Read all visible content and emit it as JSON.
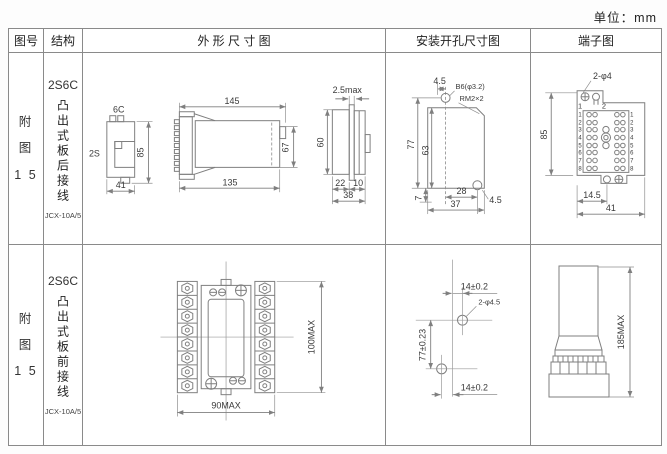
{
  "unit_label": "单位：mm",
  "headers": {
    "fig_no": "图号",
    "structure": "结构",
    "outline": "外 形 尺 寸 图",
    "mounting": "安装开孔尺寸图",
    "terminal": "端子图"
  },
  "rows": [
    {
      "fig_no": "附\n图\n1 5",
      "model": "2S6C",
      "structure_desc": "凸出式板后接线",
      "socket_note": "JCX-10A/5",
      "outline": {
        "view1": {
          "top": "6C",
          "left": "2S",
          "height": "85",
          "width": "41"
        },
        "view2": {
          "top": "145",
          "bottom": "135",
          "right": "67"
        },
        "view3": {
          "top": "2.5max",
          "left": "60",
          "b1": "22",
          "b2": "10",
          "b3": "38"
        }
      },
      "mounting": {
        "top_offset": "4.5",
        "hole_label": "B6(φ3.2)",
        "thread_label": "RM2×2",
        "height_total": "77",
        "height_inner": "63",
        "bottom_offset": "7",
        "width_inner": "28",
        "width_total": "37",
        "right_offset": "4.5"
      },
      "terminal": {
        "hole_label": "2-φ4",
        "height": "85",
        "width_inner": "14.5",
        "width_total": "41",
        "col_left": "1",
        "col_right": "2",
        "row_numbers": [
          "1",
          "2",
          "3",
          "4",
          "5",
          "6",
          "7",
          "8"
        ]
      }
    },
    {
      "fig_no": "附\n图\n1 5",
      "model": "2S6C",
      "structure_desc": "凸出式板前接线",
      "socket_note": "JCX-10A/5",
      "outline": {
        "height": "100MAX",
        "width": "90MAX"
      },
      "mounting": {
        "top_pitch": "14±0.2",
        "hole_label": "2-φ4.5",
        "height_pitch": "77±0.23",
        "bottom_pitch": "14±0.2"
      },
      "terminal": {
        "height": "185MAX"
      }
    }
  ]
}
